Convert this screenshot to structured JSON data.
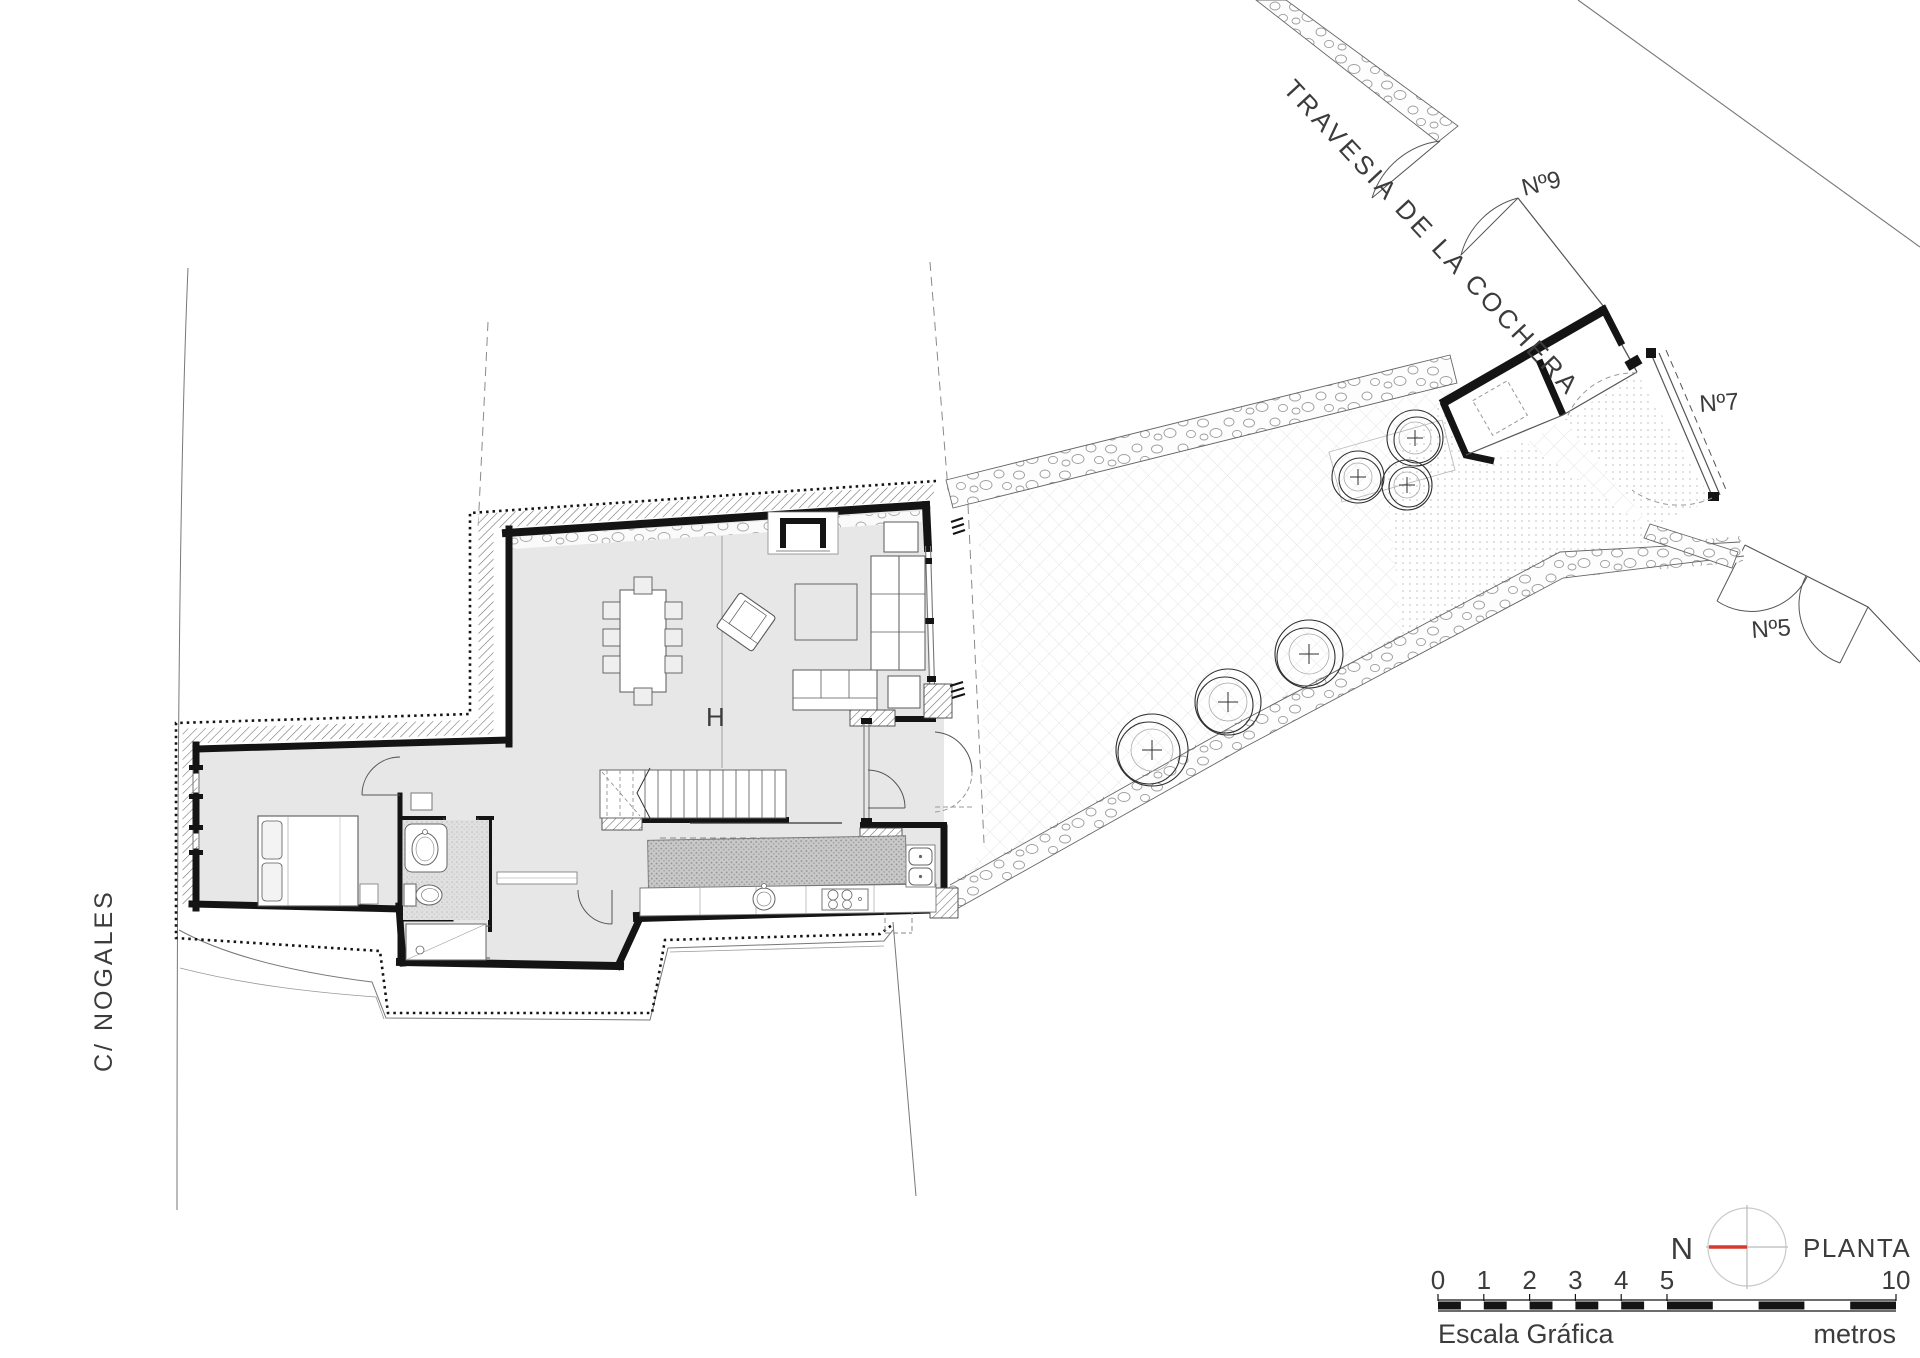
{
  "plan": {
    "name": "PLANTA BAJA",
    "north_letter": "N"
  },
  "streets": {
    "left_vertical": "C/  NOGALES",
    "top_diagonal": "TRAVESIA  DE  LA  COCHERA"
  },
  "addresses": {
    "number_9": "Nº9",
    "number_7": "Nº7",
    "number_5": "Nº5"
  },
  "labels": {
    "double_height": "H"
  },
  "scale_bar": {
    "caption": "Escala Gráfica",
    "unit": "metros",
    "ticks": [
      "0",
      "1",
      "2",
      "3",
      "4",
      "5",
      "10"
    ]
  },
  "colors": {
    "wall": "#141414",
    "north_red": "#d63a2f",
    "floor": "#e7e7e7",
    "paper": "#ffffff"
  }
}
